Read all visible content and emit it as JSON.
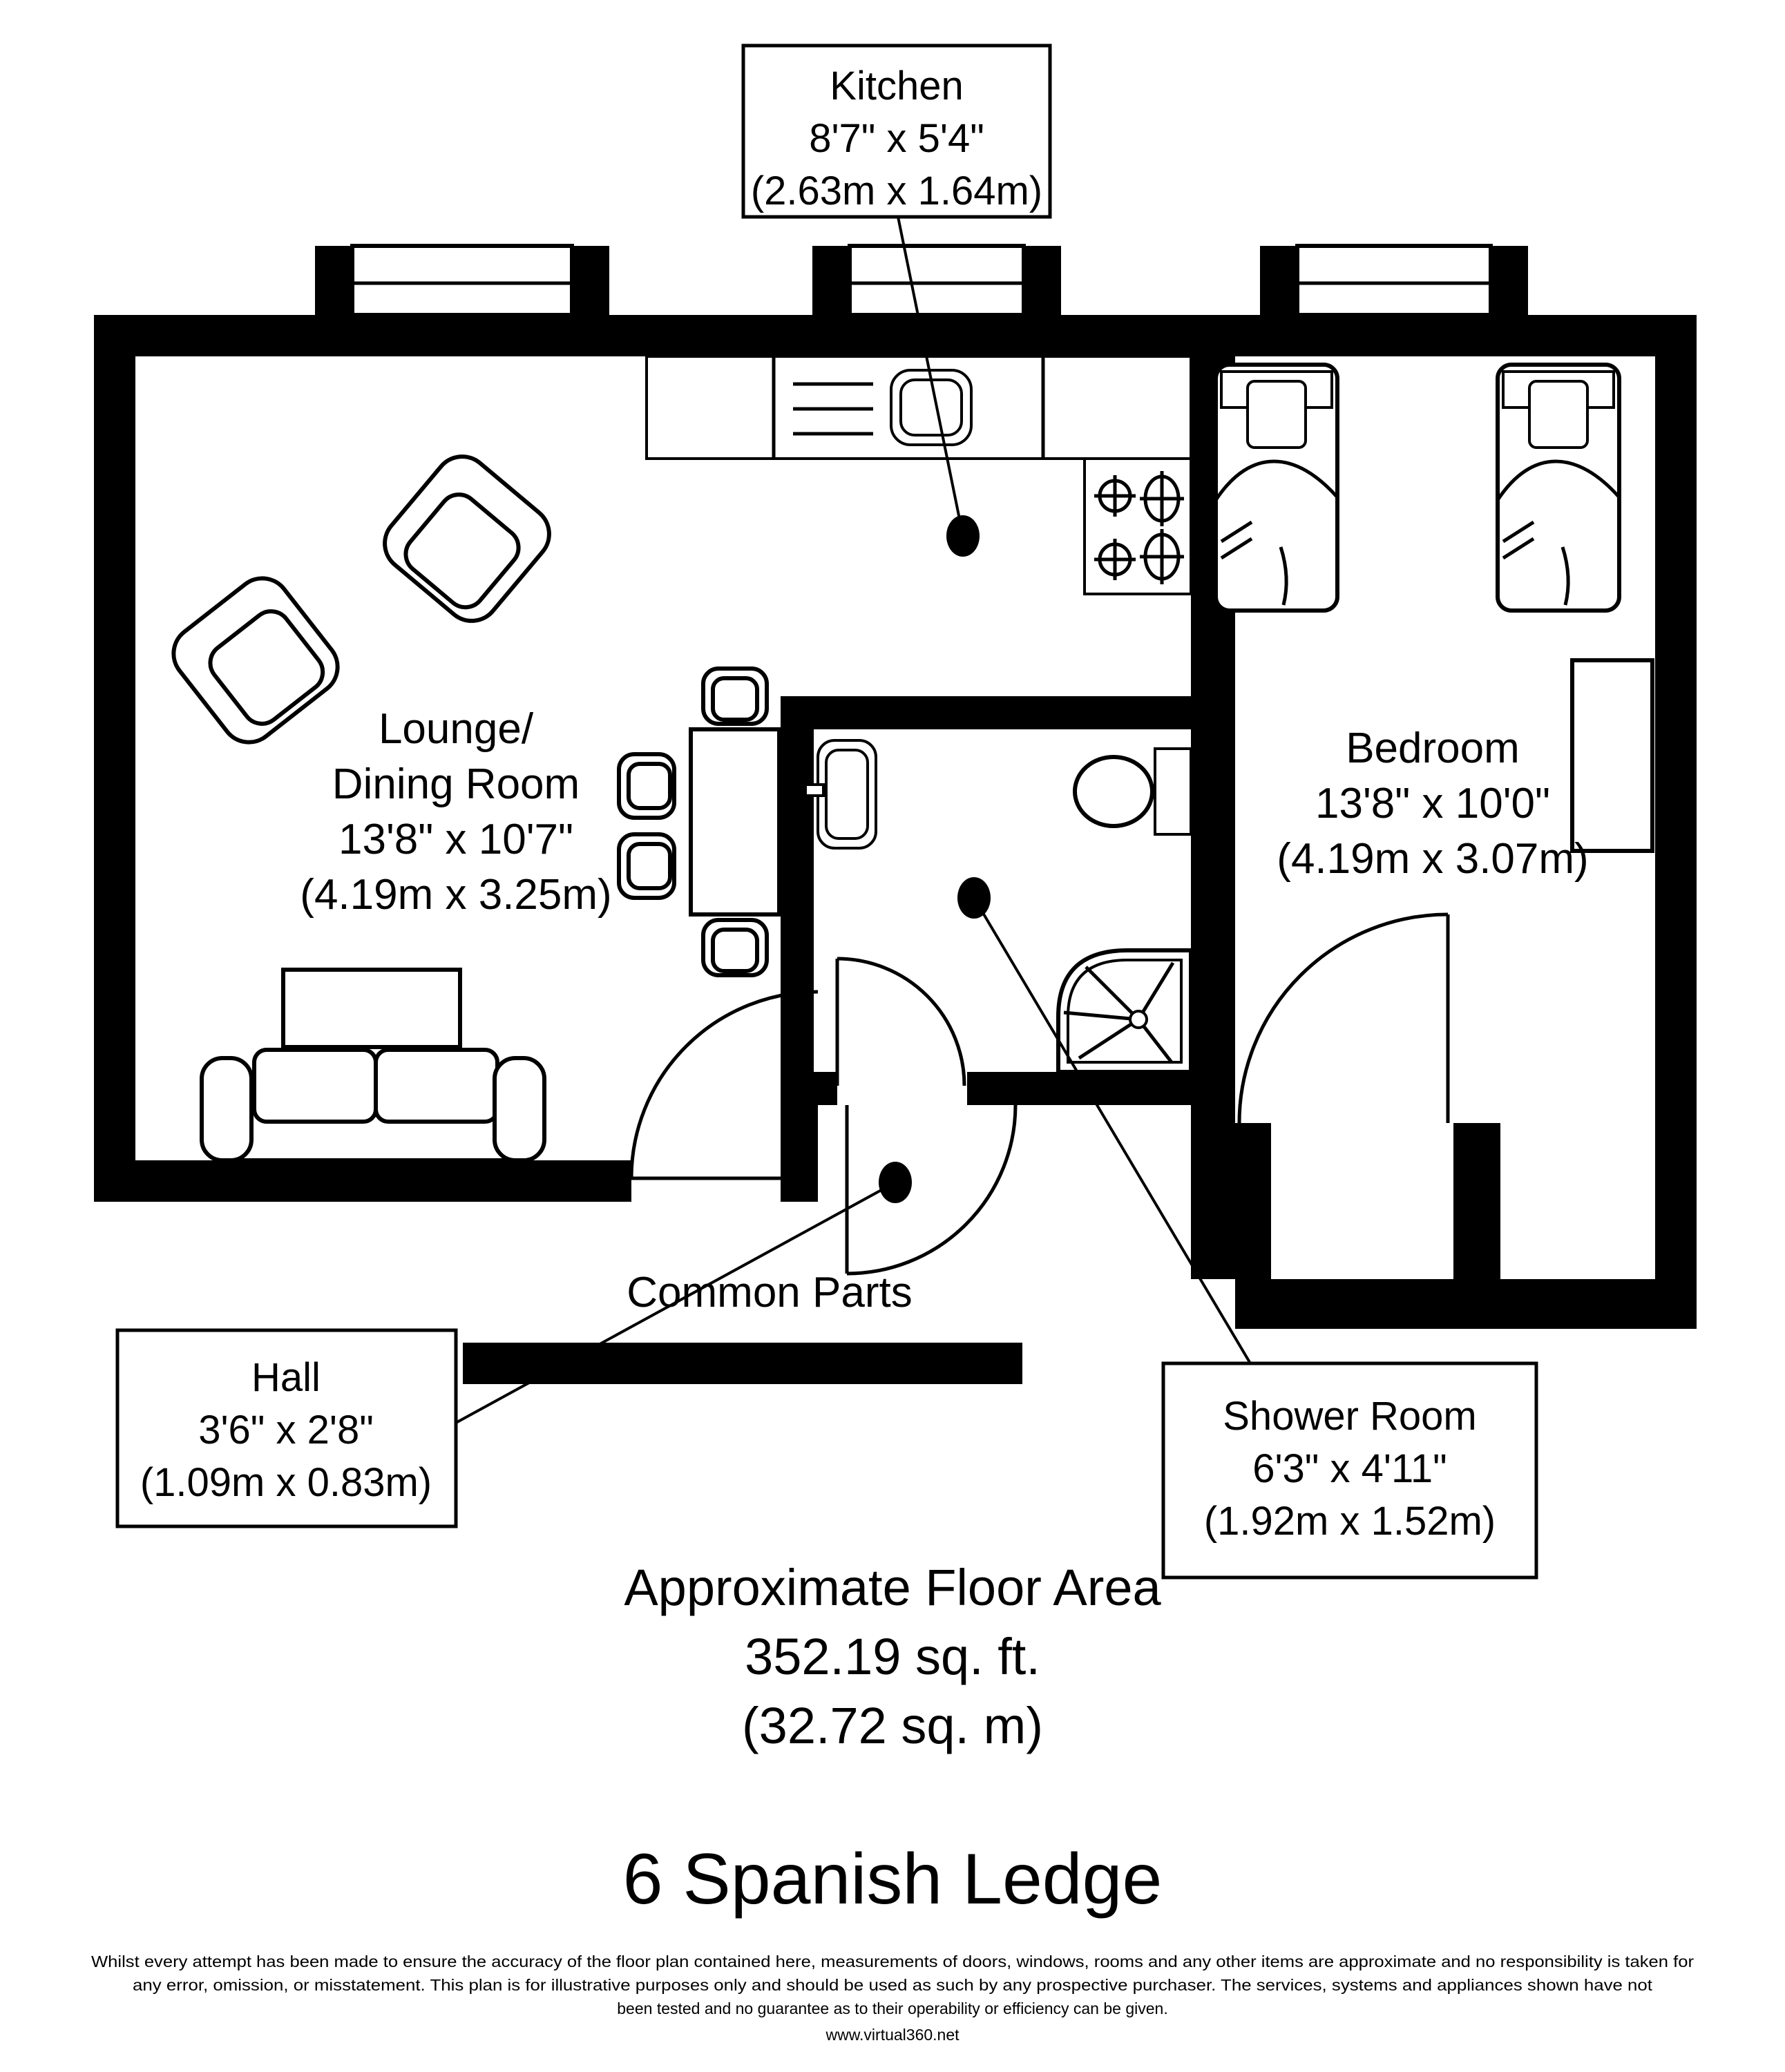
{
  "plan": {
    "labels": {
      "kitchen": {
        "name": "Kitchen",
        "imperial": "8'7\" x 5'4\"",
        "metric": "(2.63m x 1.64m)"
      },
      "lounge": {
        "name_line1": "Lounge/",
        "name_line2": "Dining Room",
        "imperial": "13'8\" x 10'7\"",
        "metric": "(4.19m x 3.25m)"
      },
      "bedroom": {
        "name": "Bedroom",
        "imperial": "13'8\" x 10'0\"",
        "metric": "(4.19m x 3.07m)"
      },
      "hall": {
        "name": "Hall",
        "imperial": "3'6\" x 2'8\"",
        "metric": "(1.09m x 0.83m)"
      },
      "shower_room": {
        "name": "Shower Room",
        "imperial": "6'3\" x 4'11\"",
        "metric": "(1.92m x 1.52m)"
      },
      "common_parts": "Common Parts"
    },
    "floor_area": {
      "line1": "Approximate Floor Area",
      "line2": "352.19 sq. ft.",
      "line3": "(32.72 sq. m)"
    },
    "title": "6 Spanish Ledge",
    "disclaimer": {
      "line1": "Whilst every attempt has been made to ensure the accuracy of the floor plan contained here, measurements of doors, windows, rooms and any other items  are approximate and no responsibility is taken for",
      "line2": "any error, omission, or misstatement. This plan is for illustrative purposes only and should be used as such by any prospective purchaser. The services, systems and appliances shown have not",
      "line3": "been tested and no guarantee as to their operability or efficiency can be given.",
      "website": "www.virtual360.net"
    },
    "colors": {
      "wall": "#000000",
      "background": "#ffffff"
    }
  }
}
